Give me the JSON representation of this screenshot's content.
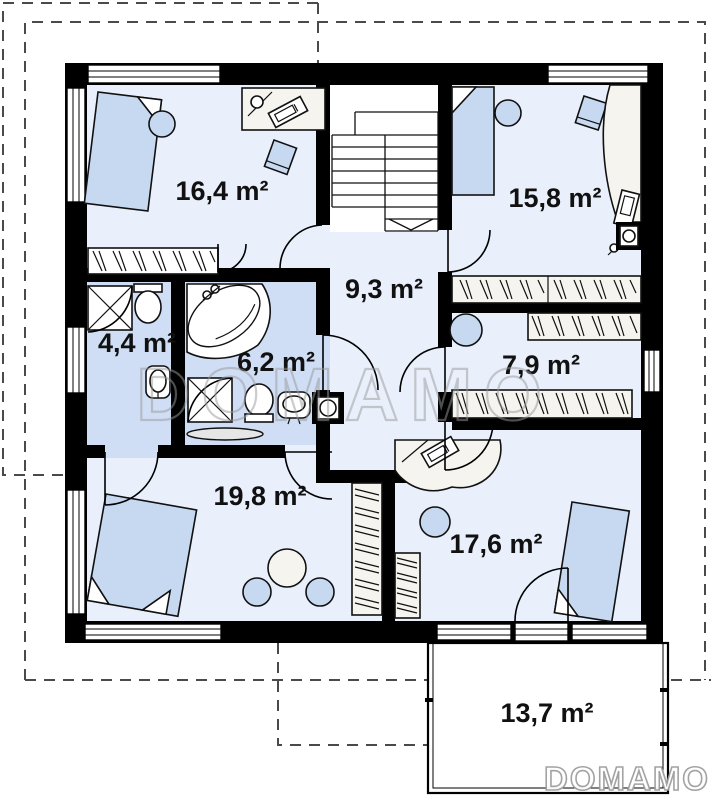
{
  "rooms": [
    {
      "id": "bedroom-top-left",
      "area_label": "16,4 m²"
    },
    {
      "id": "bedroom-top-right",
      "area_label": "15,8 m²"
    },
    {
      "id": "hall-stairs",
      "area_label": "9,3 m²"
    },
    {
      "id": "bathroom-small",
      "area_label": "4,4 m²"
    },
    {
      "id": "bathroom-large",
      "area_label": "6,2 m²"
    },
    {
      "id": "wardrobe-room",
      "area_label": "7,9 m²"
    },
    {
      "id": "bedroom-bottom-left",
      "area_label": "19,8 m²"
    },
    {
      "id": "bedroom-bottom-right",
      "area_label": "17,6 m²"
    },
    {
      "id": "terrace",
      "area_label": "13,7 m²"
    }
  ],
  "watermarks": {
    "center": "DOMAMO",
    "corner": "DOMAMO"
  },
  "colors": {
    "wall": "#000000",
    "room_fill": "#e9effb",
    "bathroom_fill": "#cfdef5",
    "furniture_blue": "#c7d9f1",
    "furniture_cream": "#f6f4ee",
    "watermark": "#9a9a9a"
  }
}
